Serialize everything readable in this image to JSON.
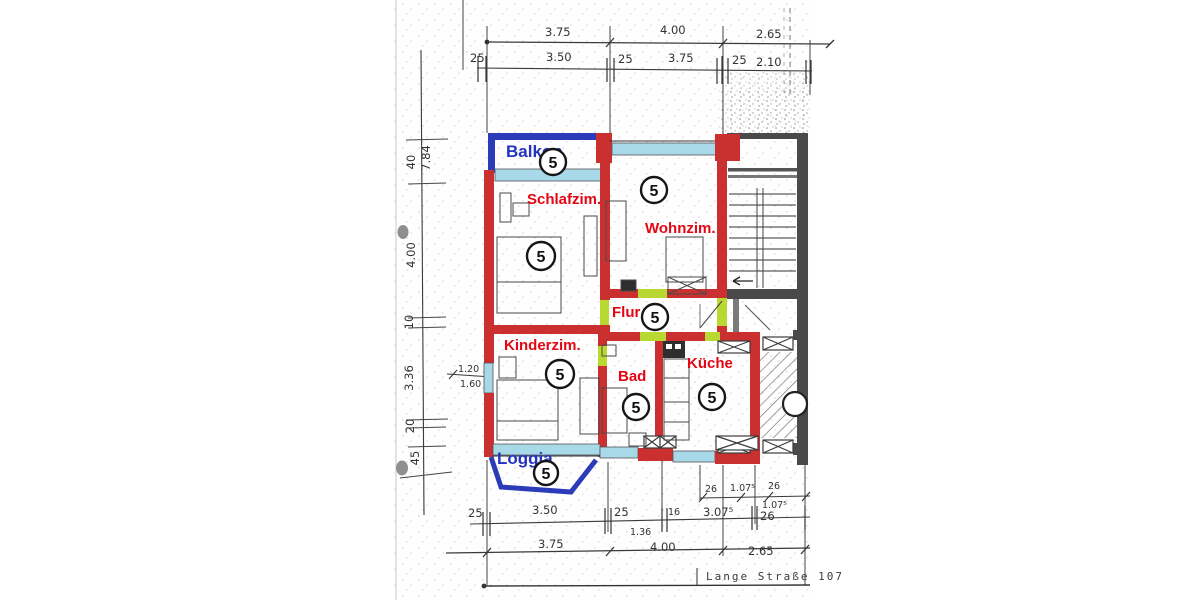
{
  "scan": {
    "street_label": "Lange Straße 107"
  },
  "colors": {
    "wall_red": "#c9302f",
    "balcony_blue": "#2c3cb8",
    "window_cyan": "#a8d9e8",
    "door_green": "#b9d832",
    "stair_gray": "#4a4a4a",
    "label_red": "#e30613",
    "label_blue": "#2433c0"
  },
  "rooms": [
    {
      "id": "balkon",
      "label": "Balkon",
      "unit": "5"
    },
    {
      "id": "schlafzimmer",
      "label": "Schlafzim.",
      "unit": "5"
    },
    {
      "id": "wohnzimmer",
      "label": "Wohnzim.",
      "unit": "5"
    },
    {
      "id": "flur",
      "label": "Flur",
      "unit": "5"
    },
    {
      "id": "kinderzimmer",
      "label": "Kinderzim.",
      "unit": "5"
    },
    {
      "id": "bad",
      "label": "Bad",
      "unit": "5"
    },
    {
      "id": "kueche",
      "label": "Küche",
      "unit": "5"
    },
    {
      "id": "loggia",
      "label": "Loggia",
      "unit": "5"
    }
  ],
  "dimensions": {
    "top_outer": [
      "3.75",
      "4.00",
      "2.65"
    ],
    "top_inner": [
      "25",
      "3.50",
      "25",
      "3.75",
      "25",
      "2.10"
    ],
    "left": [
      "7.84",
      "40",
      "4.00",
      "10",
      "3.36",
      "20",
      "45"
    ],
    "left_inner": [
      "1.20",
      "1.60"
    ],
    "bottom_inner_right": [
      "26",
      "1.07⁵",
      "26",
      "1.07⁵"
    ],
    "bottom_mid": [
      "25",
      "3.50",
      "25",
      "1.36",
      "16",
      "3.07⁵",
      "26"
    ],
    "bottom_outer": [
      "3.75",
      "4.00",
      "2.65"
    ]
  }
}
